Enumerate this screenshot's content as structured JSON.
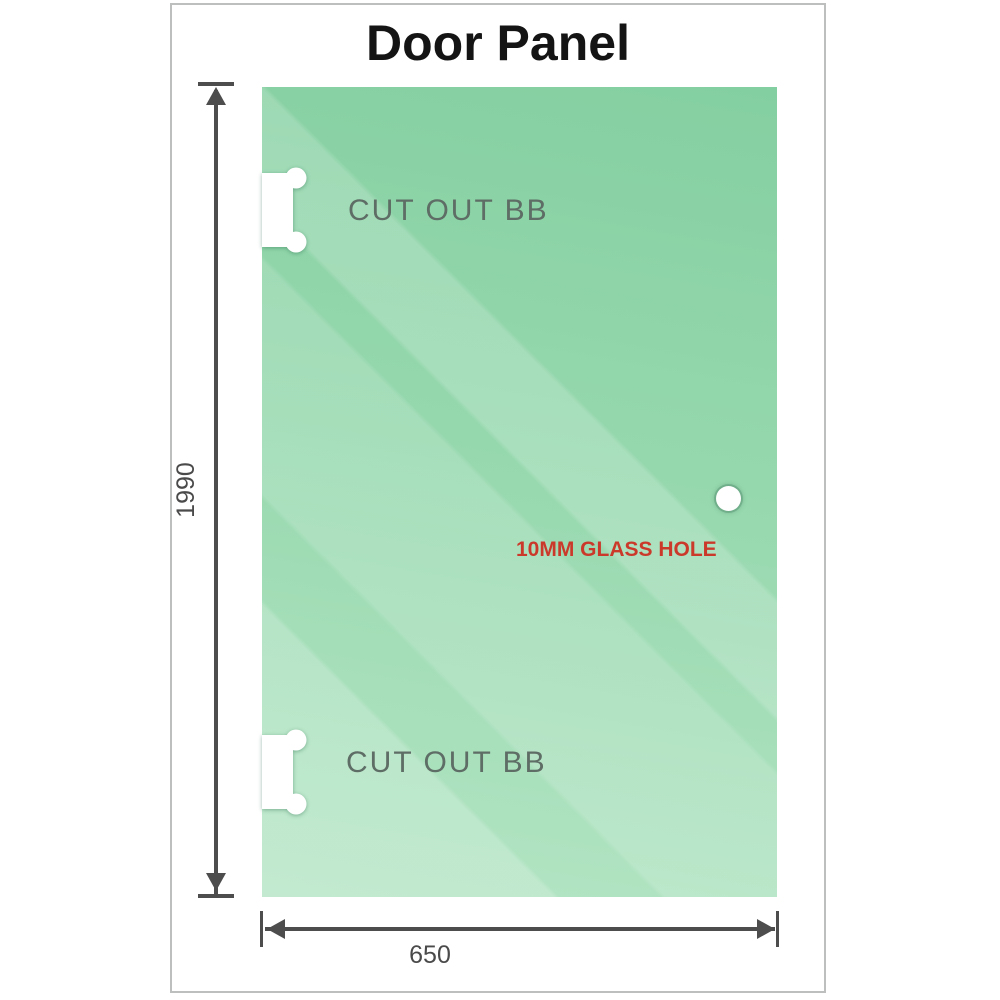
{
  "title": "Door Panel",
  "frame": {
    "border_color": "#bcbfbd",
    "background_color": "#ffffff"
  },
  "panel": {
    "glass_top_color": "#84cfa1",
    "glass_bottom_color": "#b4e5c4",
    "cutout_fill": "#ffffff",
    "cutout_top_label": "CUT OUT BB",
    "cutout_bottom_label": "CUT OUT BB",
    "cutout_label_color": "#5e6d65",
    "hole_label": "10MM GLASS HOLE",
    "hole_label_color": "#cb392b"
  },
  "dimensions": {
    "height": {
      "label": "1990"
    },
    "width": {
      "label": "650"
    },
    "line_color": "#4d4d4d",
    "text_color": "#4a4a4a"
  }
}
